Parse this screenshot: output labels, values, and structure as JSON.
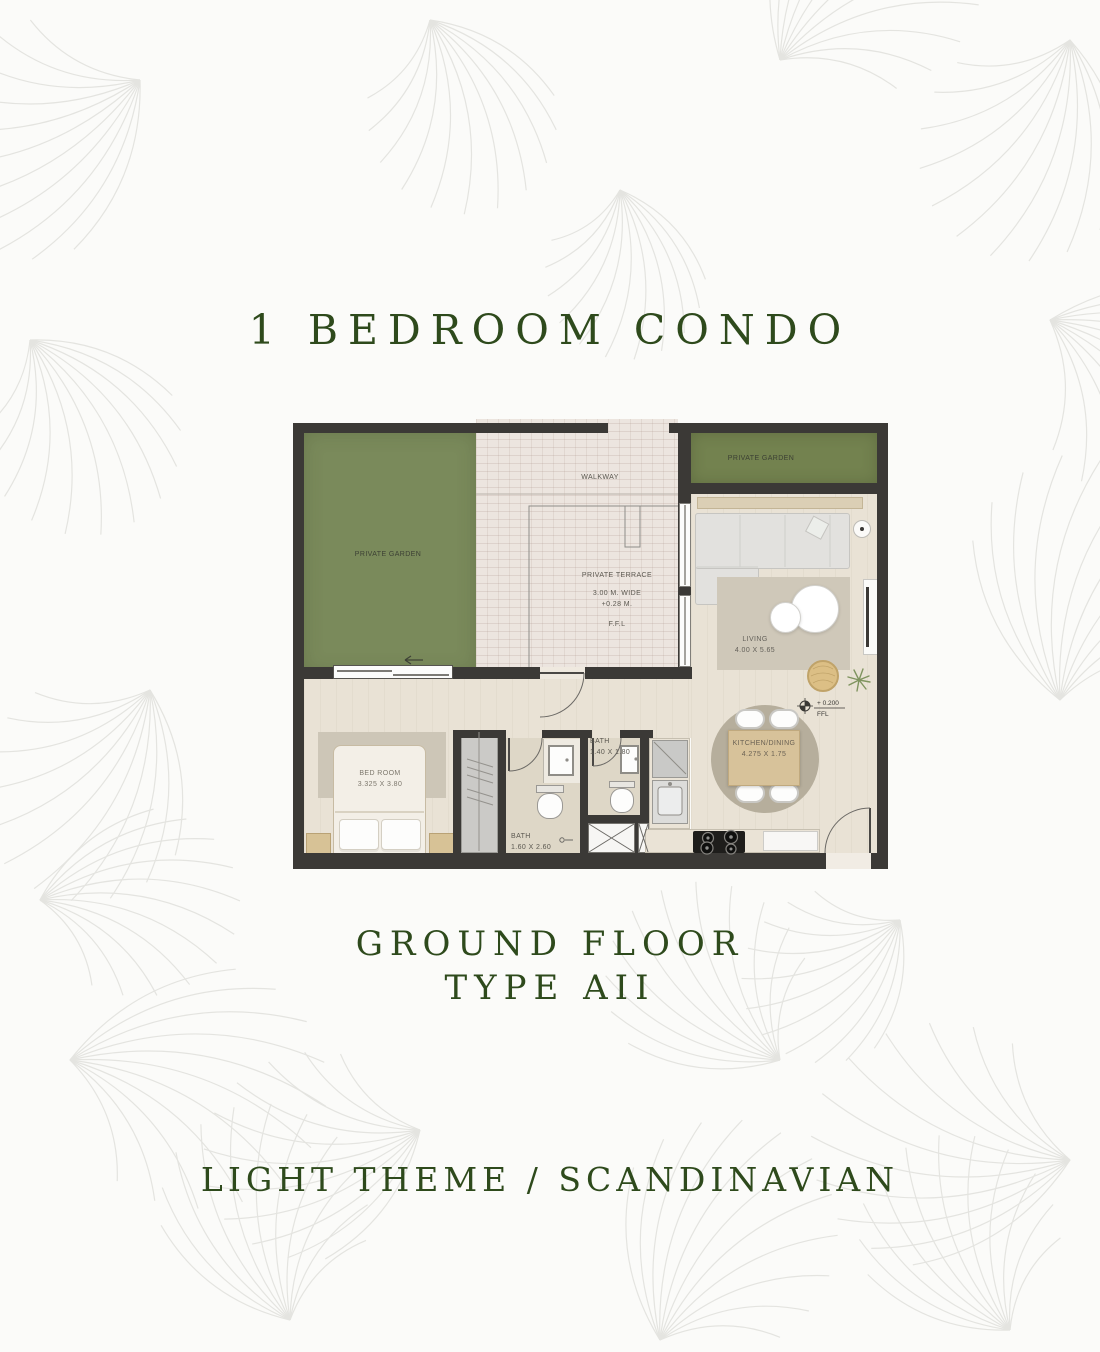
{
  "page": {
    "title": "1 BEDROOM CONDO",
    "subtitle_line1": "GROUND FLOOR",
    "subtitle_line2": "TYPE AII",
    "footer": "LIGHT THEME / SCANDINAVIAN",
    "accent_color": "#2e4a1c",
    "background_color": "#fbfbf9",
    "pattern_color": "#e4e4e0"
  },
  "floor_plan": {
    "colors": {
      "wall": "#3b3936",
      "garden_left": "#7a8a5b",
      "garden_right": "#73824f",
      "tile": "#ece5df",
      "wood_floor": "#e9e2d5",
      "bath_floor": "#ded7c7"
    },
    "labels": {
      "garden_left": "PRIVATE GARDEN",
      "garden_right": "PRIVATE GARDEN",
      "walkway": "WALKWAY",
      "terrace_name": "PRIVATE TERRACE",
      "terrace_width": "3.00 M. WIDE",
      "terrace_level": "+0.28 M.",
      "terrace_ffl": "F.F.L",
      "living_name": "LIVING",
      "living_dims": "4.00 X 5.65",
      "kitchen_name": "KITCHEN/DINING",
      "kitchen_dims": "4.275 X 1.75",
      "bedroom_name": "BED ROOM",
      "bedroom_dims": "3.325 X 3.80",
      "bath_large_name": "BATH",
      "bath_large_dims": "1.60 X 2.60",
      "bath_small_name": "BATH",
      "bath_small_dims": "1.40 X 1.80",
      "level_value": "+ 0.200",
      "level_ref": "FFL"
    }
  }
}
